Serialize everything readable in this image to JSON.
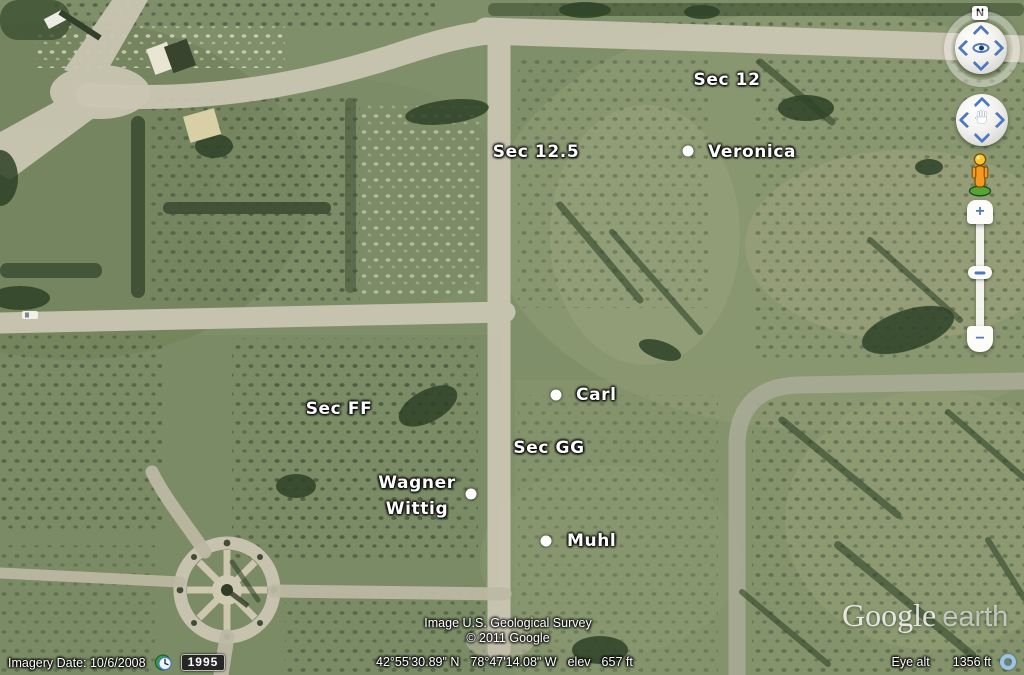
{
  "map_labels": {
    "sec_12": "Sec 12",
    "sec_12_5": "Sec 12.5",
    "sec_ff": "Sec FF",
    "sec_gg": "Sec GG"
  },
  "placemarks": {
    "veronica": "Veronica",
    "carl": "Carl",
    "muhl": "Muhl",
    "wagner_line1": "Wagner",
    "wagner_line2": "Wittig"
  },
  "attribution": {
    "imagery_source": "Image U.S. Geological Survey",
    "copyright": "© 2011 Google"
  },
  "watermark": {
    "brand": "Google",
    "product": "earth"
  },
  "status_bar": {
    "imagery_date": "Imagery Date: 10/6/2008",
    "time_badge": "1995",
    "latitude": "42°55'30.89\" N",
    "longitude": "78°47'14.08\" W",
    "elev_label": "elev",
    "elev_value": "657 ft",
    "eye_alt_label": "Eye alt",
    "eye_alt_value": "1356 ft"
  },
  "navigation": {
    "north_indicator": "N",
    "zoom_in": "+",
    "zoom_out": "−"
  },
  "colors": {
    "label_text": "#ffffff",
    "nav_arrow_blue": "#4d79bd",
    "pegman_orange": "#f59a1e",
    "road_tan": "#c9c5b2",
    "grass_green": "#7f8f6a"
  }
}
